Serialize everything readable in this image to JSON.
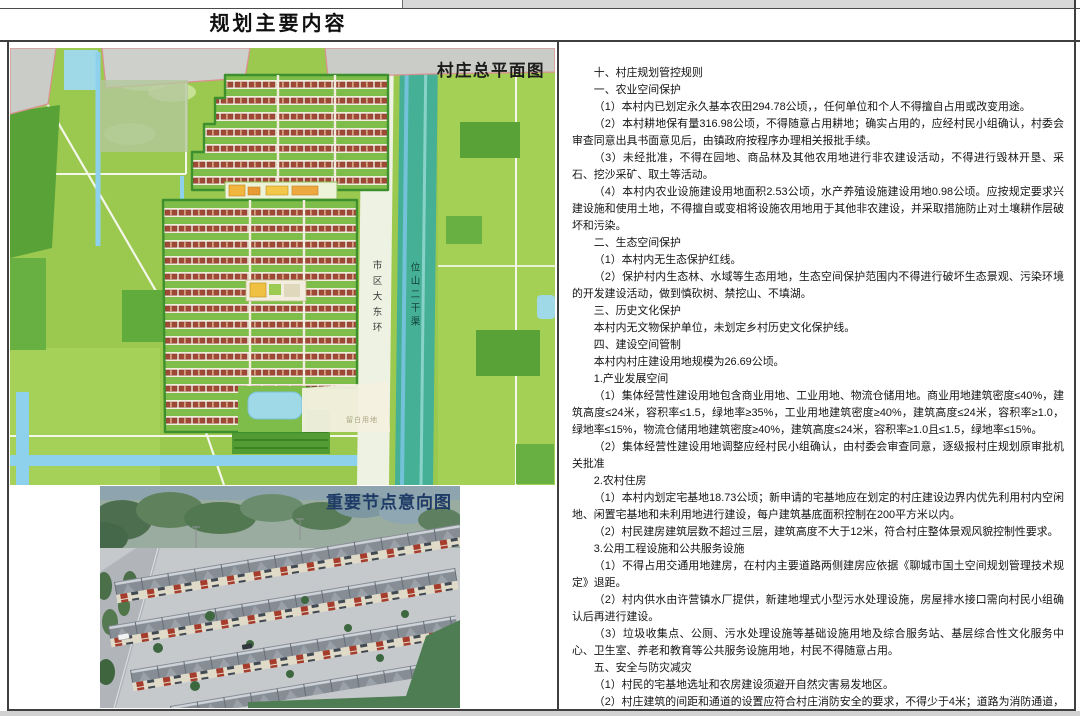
{
  "header": {
    "title": "规划主要内容"
  },
  "master_plan": {
    "label": "村庄总平面图",
    "road_label": "市区大东环",
    "canal_label": "位山二干渠",
    "reserved_land_label": "留白用地"
  },
  "node_view": {
    "label": "重要节点意向图"
  },
  "rules": {
    "paragraphs": [
      "十、村庄规划管控规则",
      "一、农业空间保护",
      "（1）本村内已划定永久基本农田294.78公顷，，任何单位和个人不得擅自占用或改变用途。",
      "（2）本村耕地保有量316.98公顷，不得随意占用耕地；确实占用的，应经村民小组确认，村委会审查同意出具书面意见后，由镇政府按程序办理相关报批手续。",
      "（3）未经批准，不得在园地、商品林及其他农用地进行非农建设活动，不得进行毁林开垦、采石、挖沙采矿、取土等活动。",
      "（4）本村内农业设施建设用地面积2.53公顷，水产养殖设施建设用地0.98公顷。应按规定要求兴建设施和使用土地，不得擅自或变相将设施农用地用于其他非农建设，并采取措施防止对土壤耕作层破坏和污染。",
      "二、生态空间保护",
      "（1）本村内无生态保护红线。",
      "（2）保护村内生态林、水域等生态用地，生态空间保护范围内不得进行破坏生态景观、污染环境的开发建设活动，做到慎砍树、禁挖山、不填湖。",
      "三、历史文化保护",
      "本村内无文物保护单位，未划定乡村历史文化保护线。",
      "四、建设空间管制",
      "本村内村庄建设用地规模为26.69公顷。",
      "1.产业发展空间",
      "（1）集体经营性建设用地包含商业用地、工业用地、物流仓储用地。商业用地建筑密度≤40%，建筑高度≤24米，容积率≤1.5，绿地率≥35%，工业用地建筑密度≥40%，建筑高度≤24米，容积率≥1.0，绿地率≤15%，物流仓储用地建筑密度≥40%，建筑高度≤24米，容积率≥1.0且≤1.5，绿地率≤15%。",
      "（2）集体经营性建设用地调整应经村民小组确认，由村委会审查同意，逐级报村庄规划原审批机关批准",
      "2.农村住房",
      "（1）本村内划定宅基地18.73公顷；新申请的宅基地应在划定的村庄建设边界内优先利用村内空闲地、闲置宅基地和未利用地进行建设，每户建筑基底面积控制在200平方米以内。",
      "（2）村民建房建筑层数不超过三层，建筑高度不大于12米，符合村庄整体景观风貌控制性要求。",
      "3.公用工程设施和公共服务设施",
      "（1）不得占用交通用地建房，在村内主要道路两侧建房应依据《聊城市国土空间规划管理技术规定》退距。",
      "（2）村内供水由许营镇水厂提供，新建地埋式小型污水处理设施，房屋排水接口需向村民小组确认后再进行建设。",
      "（3）垃圾收集点、公厕、污水处理设施等基础设施用地及综合服务站、基层综合性文化服务中心、卫生室、养老和教育等公共服务设施用地，村民不得随意占用。",
      "五、安全与防灾减灾",
      "（1）村民的宅基地选址和农房建设须避开自然灾害易发地区。",
      "（2）村庄建筑的间距和通道的设置应符合村庄消防安全的要求，不得少于4米；道路为消防通道，不准长期堆放阻碍交通的杂物。",
      "（3）公园绿地、公共活动广场等为防灾避险场所，紧急情况下可躲避灾害。"
    ]
  },
  "colors": {
    "field_green": "#9bc84e",
    "water_blue": "#8ed1ec",
    "canal_teal": "#45b096",
    "roof_red": "#a04a36",
    "urban_grey": "#c9ccc7",
    "boundary_pink": "#dc8f8f",
    "label_navy": "#1e3a66"
  }
}
